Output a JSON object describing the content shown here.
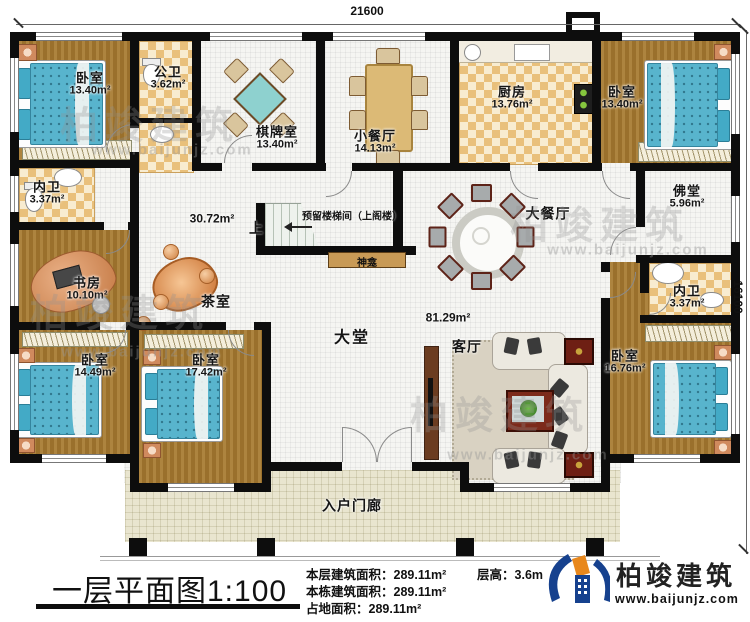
{
  "dimensions": {
    "top": "21600",
    "right": "16100"
  },
  "rooms": {
    "bedroom_tl": {
      "name": "卧室",
      "area": "13.40m²"
    },
    "public_bath": {
      "name": "公卫",
      "area": "3.62m²"
    },
    "chess_room": {
      "name": "棋牌室",
      "area": "13.40m²"
    },
    "small_dining": {
      "name": "小餐厅",
      "area": "14.13m²"
    },
    "kitchen": {
      "name": "厨房",
      "area": "13.76m²"
    },
    "bedroom_tr": {
      "name": "卧室",
      "area": "13.40m²"
    },
    "bath_left": {
      "name": "内卫",
      "area": "3.37m²"
    },
    "study": {
      "name": "书房",
      "area": "10.10m²"
    },
    "hall": {
      "area": "30.72m²"
    },
    "tea_room": {
      "name": "茶室"
    },
    "buddha_hall": {
      "name": "佛堂",
      "area": "5.96m²"
    },
    "big_dining": {
      "name": "大餐厅"
    },
    "lobby": {
      "name": "大堂",
      "area": "81.29m²"
    },
    "living": {
      "name": "客厅"
    },
    "bath_right": {
      "name": "内卫",
      "area": "3.37m²"
    },
    "bedroom_r": {
      "name": "卧室",
      "area": "16.76m²"
    },
    "bedroom_bl": {
      "name": "卧室",
      "area": "14.49m²"
    },
    "bedroom_bm": {
      "name": "卧室",
      "area": "17.42m²"
    },
    "porch": {
      "name": "入户门廊"
    }
  },
  "stairs": {
    "up": "上",
    "note": "预留楼梯间（上阁楼）",
    "shrine": "神龛"
  },
  "footer": {
    "title": "一层平面图",
    "scale": "1:100",
    "stats": [
      {
        "label": "本层建筑面积：",
        "value": "289.11m²"
      },
      {
        "label": "本栋建筑面积：",
        "value": "289.11m²"
      },
      {
        "label": "占地面积：",
        "value": "289.11m²"
      }
    ],
    "floor_height_label": "层高：",
    "floor_height": "3.6m",
    "brand": "柏竣建筑",
    "website": "www.baijunjz.com"
  },
  "watermark": {
    "brand": "柏竣建筑",
    "site": "www.baijunjz.com"
  },
  "colors": {
    "wall": "#0d0d0d",
    "wood_floor": "#a6792f",
    "tile": "#e9c07b",
    "bed": "#58b4cd",
    "porch": "#e9e5cf",
    "logo_blue": "#16418e",
    "logo_orange": "#e8881d"
  }
}
